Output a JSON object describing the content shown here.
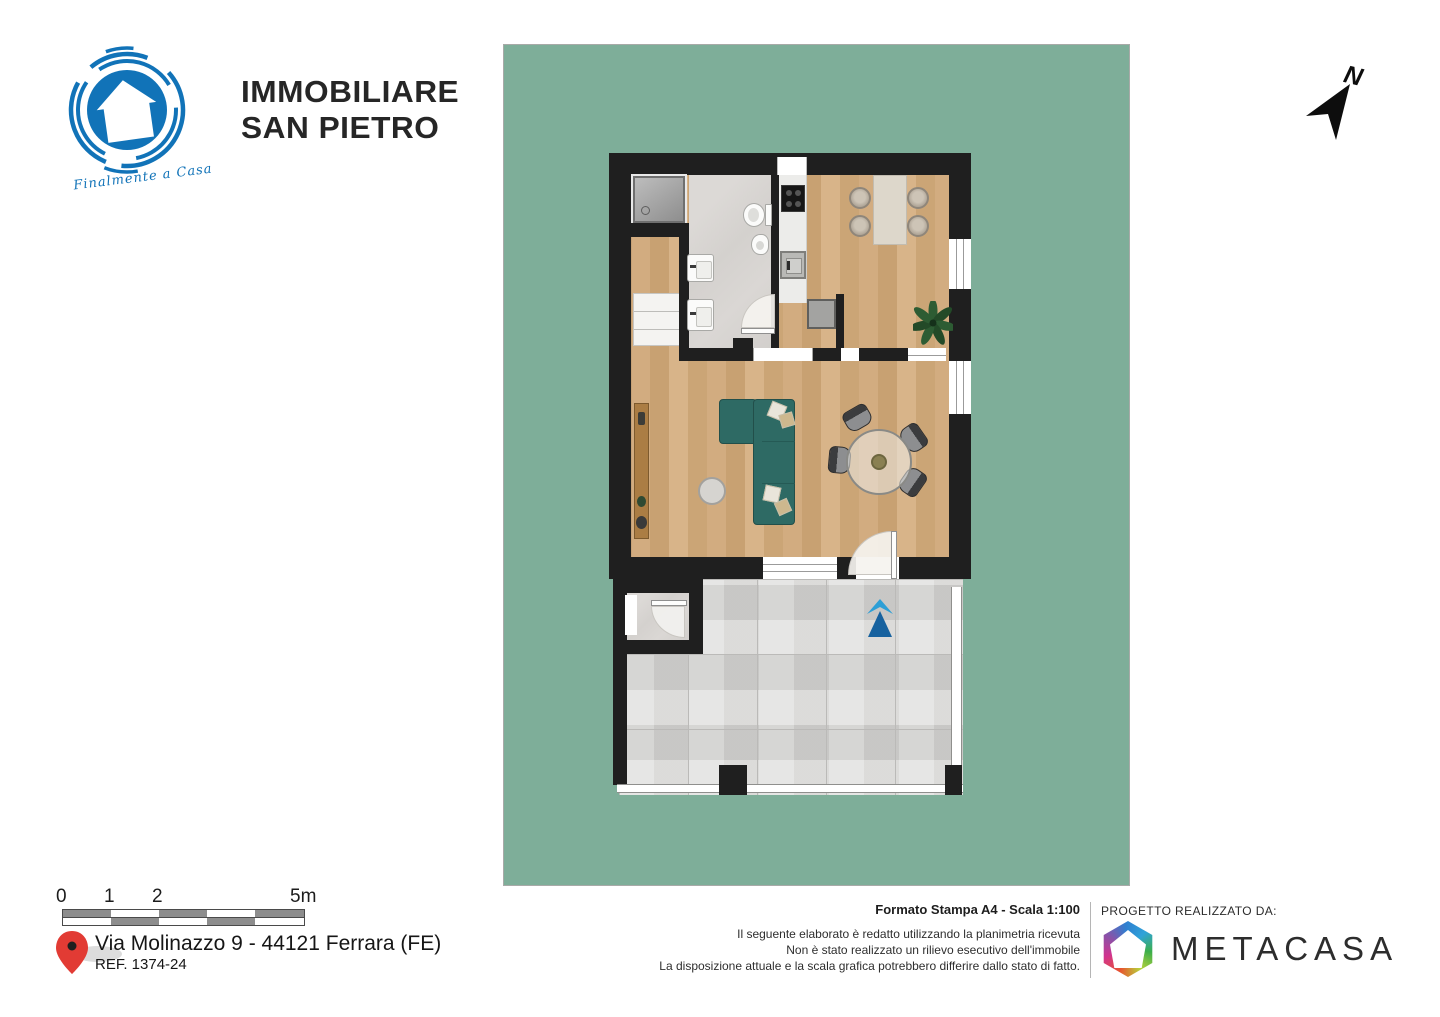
{
  "branding": {
    "agency": {
      "line1": "IMMOBILIARE",
      "line2": "SAN PIETRO",
      "tagline": "Finalmente a Casa",
      "brand_color": "#1173b8"
    }
  },
  "north_indicator": {
    "label": "N"
  },
  "plan": {
    "background_color": "#7eae99",
    "wall_color": "#1f1f1f",
    "wood_floor_color": "#cda97d",
    "bathroom_tile_color": "#d7d4d1",
    "terrace_tile_color": "#d5d4d2",
    "sofa_color": "#2e6a64",
    "entry_arrow_light": "#2d9fd6",
    "entry_arrow_dark": "#17629f"
  },
  "scale_bar": {
    "labels": [
      "0",
      "1",
      "2",
      "5m"
    ]
  },
  "location": {
    "address": "Via Molinazzo 9 - 44121 Ferrara (FE)",
    "reference": "REF. 1374-24",
    "pin_color": "#e23b34"
  },
  "print_info": {
    "format": "Formato Stampa A4 - Scala 1:100",
    "disclaimer": [
      "Il seguente elaborato è redatto utilizzando la planimetria ricevuta",
      "Non è stato realizzato un rilievo esecutivo dell'immobile",
      "La disposizione attuale e la scala grafica potrebbero differire dallo stato di fatto."
    ]
  },
  "credits": {
    "label": "PROGETTO REALIZZATO DA:",
    "company": "METACASA"
  }
}
